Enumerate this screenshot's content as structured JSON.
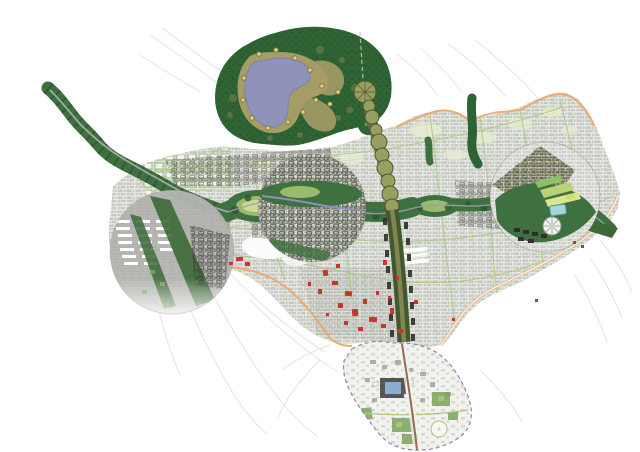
{
  "image": {
    "width": 640,
    "height": 452
  },
  "map": {
    "kind": "urban-masterplan-map",
    "features": [
      "forest-park",
      "lake",
      "lake-wetland",
      "lake-viewpoints",
      "forest-road",
      "river-greenway-west-arm",
      "central-greenway",
      "river",
      "city-fabric",
      "green-street-network",
      "pale-park-patches",
      "city-boundary-north",
      "southeast-edge-band",
      "historic-core-boundary",
      "historic-red-buildings",
      "west-district-circle",
      "center-district-circle",
      "east-district-circle",
      "stadium",
      "glass-building",
      "north-south-spine",
      "spine-node-chain",
      "north-green-fingers",
      "southern-extension-district",
      "campus-complex",
      "southern-axis",
      "context-road-sketch"
    ]
  },
  "colors": {
    "white": "#ffffff",
    "paper": "#f7f8f4",
    "sketch": "#e0e0db",
    "sketch_dark": "#cfcfca",
    "fabric_base": "#ebece8",
    "fabric_block": "#c2c3bf",
    "fabric_block_dense": "#a6a7a3",
    "black_blocks": "#2f2f2c",
    "green_block_line": "#8cb468",
    "street_green": "#a9c87e",
    "pale_patch": "#e7ead2",
    "white_building": "#ffffff",
    "orange_boundary": "#e9a76c",
    "tan_band": "#e6bb90",
    "red_building": "#c5372c",
    "forest": "#2e6434",
    "forest_speckle": "#1f4a26",
    "clearing_olive": "#6e7a48",
    "wetland": "#a59c66",
    "lake": "#8f93ba",
    "lake_edge": "#7d81a6",
    "poi_yellow": "#e0d077",
    "poi_ring": "#7a7040",
    "corridor": "#3f7040",
    "corridor_tree": "#2b5630",
    "meadow": "#9cba6e",
    "meadow_pale": "#cdd994",
    "river": "#9aa0ad",
    "river_purple": "#8f8fb8",
    "road_gray": "#a8adaf",
    "gray_circle": "#b7b8b4",
    "dark_band": "#3d6939",
    "olive_block": "#77774a",
    "spine_dark": "#42592f",
    "spine_olive": "#8a8a55",
    "node_fill": "#97a060",
    "node_ring": "#55552e",
    "chain_band": "#6f6f42",
    "teal": "#a6d6da",
    "teal_edge": "#4f939b",
    "stadium": "#f0f1ec",
    "stadium_edge": "#9a9a94",
    "strip_light": "#b9d275",
    "strip_pale": "#dce48f",
    "strip_green": "#8fbf68",
    "yellow_patch": "#cfe06a",
    "purple_boundary": "#8f74ac",
    "south_fill": "#f2f2ef",
    "south_block": "#cfcfc9",
    "south_axis": "#9a6a50",
    "blue_court": "#8fabcf",
    "complex_dark": "#3c3c38",
    "park_green": "#7da45c",
    "circle_edge": "#6a6a66",
    "forest_road": "#c2c2b2"
  }
}
